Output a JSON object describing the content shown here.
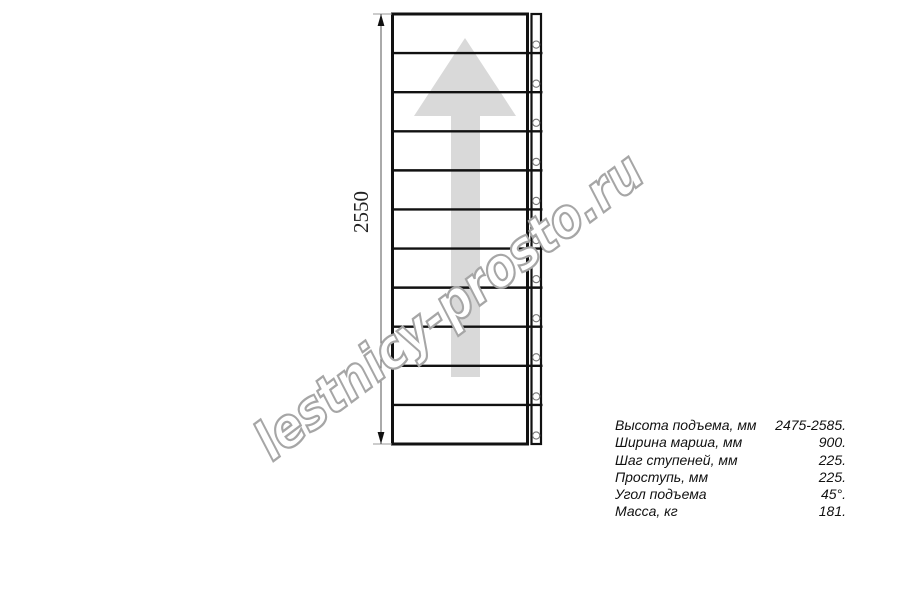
{
  "watermark": {
    "text": "lestnicy-prosto.ru",
    "outline_color": "#a6a6a6",
    "fill_color": "#ffffff"
  },
  "drawing": {
    "dimension_label": "2550",
    "steps_count": 11,
    "holes_count": 11,
    "arrow_color": "#d9d9d9",
    "line_color": "#111111",
    "dim_line_color": "#555555",
    "hole_stroke_color": "#777777"
  },
  "specs": {
    "rows": [
      {
        "label": "Высота подъема, мм",
        "value": "2475-2585."
      },
      {
        "label": "Ширина марша, мм",
        "value": "900."
      },
      {
        "label": "Шаг ступеней, мм",
        "value": "225."
      },
      {
        "label": "Проступь, мм",
        "value": "225."
      },
      {
        "label": "Угол подъема",
        "value": "45°."
      },
      {
        "label": "Масса, кг",
        "value": "181."
      }
    ]
  }
}
